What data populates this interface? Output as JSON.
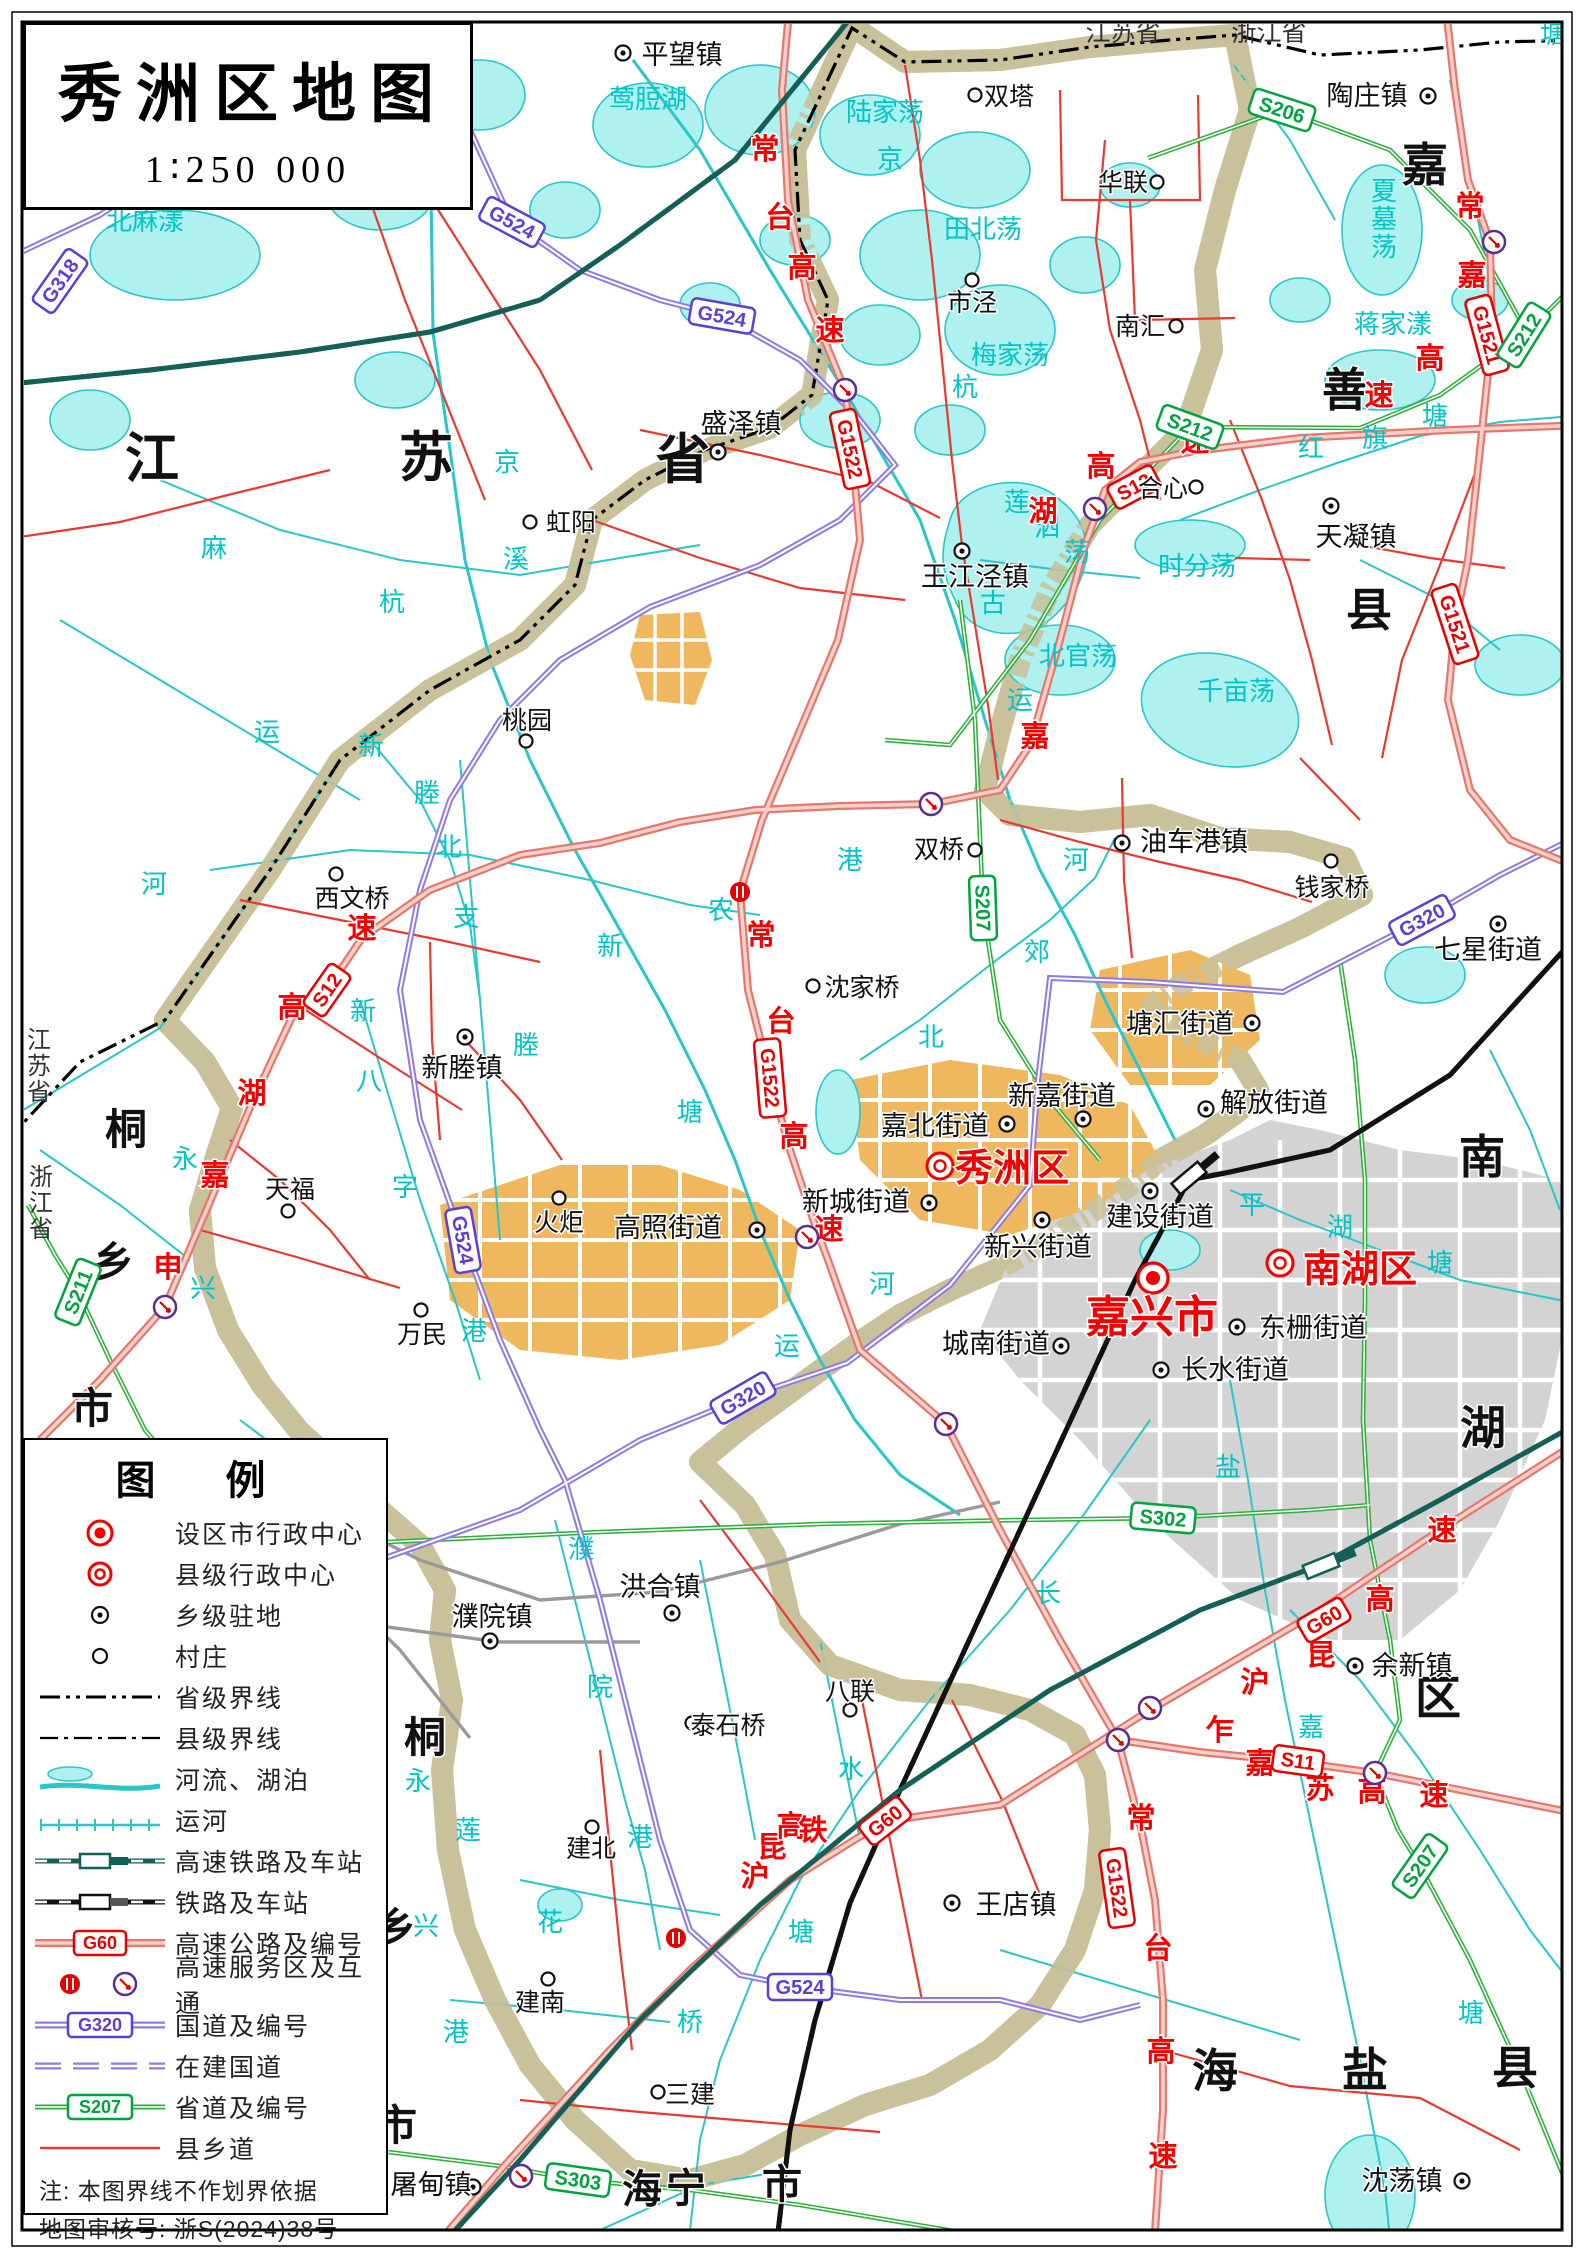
{
  "title": {
    "text": "秀洲区地图",
    "scale": "1∶250 000"
  },
  "legend": {
    "title": "图  例",
    "rows": [
      {
        "sym": "city",
        "label": "设区市行政中心"
      },
      {
        "sym": "county",
        "label": "县级行政中心"
      },
      {
        "sym": "town",
        "label": "乡级驻地"
      },
      {
        "sym": "village",
        "label": "村庄"
      },
      {
        "sym": "provline",
        "label": "省级界线"
      },
      {
        "sym": "countyline",
        "label": "县级界线"
      },
      {
        "sym": "water",
        "label": "河流、湖泊"
      },
      {
        "sym": "canal",
        "label": "运河"
      },
      {
        "sym": "hsr",
        "label": "高速铁路及车站"
      },
      {
        "sym": "rail",
        "label": "铁路及车站"
      },
      {
        "sym": "hwy",
        "label": "高速公路及编号"
      },
      {
        "sym": "service",
        "label": "高速服务区及互通"
      },
      {
        "sym": "nroad",
        "label": "国道及编号"
      },
      {
        "sym": "nbuild",
        "label": "在建国道"
      },
      {
        "sym": "proad",
        "label": "省道及编号"
      },
      {
        "sym": "croad",
        "label": "县乡道"
      }
    ],
    "notes": [
      "注:  本图界线不作划界依据",
      "地图审核号:  浙S(2024)38号"
    ]
  },
  "colors": {
    "district": "#FBF8D0",
    "band": "#C8C19A",
    "water_fill": "#AEF1EF",
    "water_line": "#2AC6C8",
    "urban_grey": "#D3D3D3",
    "urban_orange": "#EFB85F",
    "hwy": "#E4786E",
    "nroad": "#8F7BE8",
    "proad": "#2FAF3C",
    "croad": "#E83A30",
    "hsr": "#145F56",
    "red_text": "#F50000",
    "cyan_text": "#00C4C6"
  },
  "regions": [
    {
      "name": "jiangsu-province-big",
      "fs": 54,
      "chars": [
        {
          "c": "江",
          "x": 152,
          "y": 477
        },
        {
          "c": "苏",
          "x": 426,
          "y": 476
        },
        {
          "c": "省",
          "x": 683,
          "y": 478
        }
      ]
    },
    {
      "name": "jiashan-county",
      "fs": 46,
      "chars": [
        {
          "c": "嘉",
          "x": 1425,
          "y": 181
        },
        {
          "c": "善",
          "x": 1345,
          "y": 406
        },
        {
          "c": "县",
          "x": 1369,
          "y": 626
        }
      ]
    },
    {
      "name": "nanhu-district",
      "fs": 46,
      "chars": [
        {
          "c": "南",
          "x": 1482,
          "y": 1173
        },
        {
          "c": "湖",
          "x": 1483,
          "y": 1444
        },
        {
          "c": "区",
          "x": 1438,
          "y": 1714
        }
      ]
    },
    {
      "name": "tongxiang-city-n",
      "fs": 42,
      "chars": [
        {
          "c": "桐",
          "x": 126,
          "y": 1144
        },
        {
          "c": "乡",
          "x": 113,
          "y": 1277
        },
        {
          "c": "市",
          "x": 92,
          "y": 1423
        }
      ]
    },
    {
      "name": "tongxiang-city-s",
      "fs": 42,
      "chars": [
        {
          "c": "桐",
          "x": 425,
          "y": 1752
        },
        {
          "c": "乡",
          "x": 395,
          "y": 1943
        },
        {
          "c": "市",
          "x": 396,
          "y": 2140
        }
      ]
    },
    {
      "name": "haining-city",
      "fs": 40,
      "chars": [
        {
          "c": "海",
          "x": 642,
          "y": 2203
        },
        {
          "c": "宁",
          "x": 686,
          "y": 2202
        },
        {
          "c": "市",
          "x": 782,
          "y": 2198
        }
      ]
    },
    {
      "name": "haiyan-county",
      "fs": 46,
      "chars": [
        {
          "c": "海",
          "x": 1215,
          "y": 2087
        },
        {
          "c": "盐",
          "x": 1365,
          "y": 2086
        },
        {
          "c": "县",
          "x": 1515,
          "y": 2084
        }
      ]
    }
  ],
  "small_regions": [
    {
      "t": "江苏省",
      "x": 39,
      "y": 1048,
      "vert": true
    },
    {
      "t": "浙江省",
      "x": 41,
      "y": 1185,
      "vert": true
    },
    {
      "t": "江苏省",
      "x": 1123,
      "y": 41,
      "vert": false
    },
    {
      "t": "浙江省",
      "x": 1269,
      "y": 41,
      "vert": false
    }
  ],
  "places": [
    {
      "n": "嘉兴市",
      "t": "city",
      "mx": 1153,
      "my": 1278,
      "lx": 1152,
      "ly": 1318
    },
    {
      "n": "秀洲区",
      "t": "county",
      "mx": 940,
      "my": 1166,
      "lx": 1012,
      "ly": 1167
    },
    {
      "n": "南湖区",
      "t": "county",
      "mx": 1280,
      "my": 1263,
      "lx": 1360,
      "ly": 1268
    },
    {
      "n": "平望镇",
      "t": "town",
      "mx": 623,
      "my": 53,
      "lx": 682,
      "ly": 55
    },
    {
      "n": "陶庄镇",
      "t": "town",
      "mx": 1428,
      "my": 96,
      "lx": 1367,
      "ly": 96
    },
    {
      "n": "盛泽镇",
      "t": "town",
      "mx": 718,
      "my": 452,
      "lx": 741,
      "ly": 424
    },
    {
      "n": "天凝镇",
      "t": "town",
      "mx": 1331,
      "my": 506,
      "lx": 1356,
      "ly": 537
    },
    {
      "n": "王江泾镇",
      "t": "town",
      "mx": 962,
      "my": 551,
      "lx": 975,
      "ly": 577
    },
    {
      "n": "油车港镇",
      "t": "town",
      "mx": 1122,
      "my": 843,
      "lx": 1194,
      "ly": 842
    },
    {
      "n": "七星街道",
      "t": "town",
      "mx": 1498,
      "my": 924,
      "lx": 1488,
      "ly": 950
    },
    {
      "n": "新塍镇",
      "t": "town",
      "mx": 465,
      "my": 1037,
      "lx": 462,
      "ly": 1068
    },
    {
      "n": "塘汇街道",
      "t": "town",
      "mx": 1252,
      "my": 1023,
      "lx": 1180,
      "ly": 1024
    },
    {
      "n": "新嘉街道",
      "t": "town",
      "mx": 1083,
      "my": 1119,
      "lx": 1062,
      "ly": 1096
    },
    {
      "n": "解放街道",
      "t": "town",
      "mx": 1206,
      "my": 1109,
      "lx": 1274,
      "ly": 1103
    },
    {
      "n": "嘉北街道",
      "t": "town",
      "mx": 1007,
      "my": 1124,
      "lx": 935,
      "ly": 1126
    },
    {
      "n": "新城街道",
      "t": "town",
      "mx": 929,
      "my": 1203,
      "lx": 856,
      "ly": 1202
    },
    {
      "n": "建设街道",
      "t": "town",
      "mx": 1150,
      "my": 1191,
      "lx": 1160,
      "ly": 1217
    },
    {
      "n": "高照街道",
      "t": "town",
      "mx": 757,
      "my": 1230,
      "lx": 668,
      "ly": 1228
    },
    {
      "n": "新兴街道",
      "t": "town",
      "mx": 1042,
      "my": 1220,
      "lx": 1038,
      "ly": 1247
    },
    {
      "n": "城南街道",
      "t": "town",
      "mx": 1061,
      "my": 1346,
      "lx": 996,
      "ly": 1344
    },
    {
      "n": "东栅街道",
      "t": "town",
      "mx": 1237,
      "my": 1327,
      "lx": 1313,
      "ly": 1328
    },
    {
      "n": "长水街道",
      "t": "town",
      "mx": 1161,
      "my": 1370,
      "lx": 1235,
      "ly": 1370
    },
    {
      "n": "洪合镇",
      "t": "town",
      "mx": 672,
      "my": 1613,
      "lx": 660,
      "ly": 1587
    },
    {
      "n": "濮院镇",
      "t": "town",
      "mx": 490,
      "my": 1641,
      "lx": 492,
      "ly": 1617
    },
    {
      "n": "王店镇",
      "t": "town",
      "mx": 952,
      "my": 1903,
      "lx": 1016,
      "ly": 1905
    },
    {
      "n": "余新镇",
      "t": "town",
      "mx": 1355,
      "my": 1666,
      "lx": 1412,
      "ly": 1666
    },
    {
      "n": "屠甸镇",
      "t": "town",
      "mx": 473,
      "my": 2187,
      "lx": 431,
      "ly": 2185
    },
    {
      "n": "沈荡镇",
      "t": "town",
      "mx": 1462,
      "my": 2181,
      "lx": 1402,
      "ly": 2181
    },
    {
      "n": "双塔",
      "t": "village",
      "mx": 975,
      "my": 95,
      "lx": 1009,
      "ly": 96
    },
    {
      "n": "华联",
      "t": "village",
      "mx": 1157,
      "my": 182,
      "lx": 1123,
      "ly": 182
    },
    {
      "n": "市泾",
      "t": "village",
      "mx": 972,
      "my": 280,
      "lx": 972,
      "ly": 302
    },
    {
      "n": "南汇",
      "t": "village",
      "mx": 1176,
      "my": 326,
      "lx": 1140,
      "ly": 326
    },
    {
      "n": "合心",
      "t": "village",
      "mx": 1196,
      "my": 487,
      "lx": 1163,
      "ly": 488
    },
    {
      "n": "桃园",
      "t": "village",
      "mx": 526,
      "my": 741,
      "lx": 527,
      "ly": 720
    },
    {
      "n": "虹阳",
      "t": "village",
      "mx": 530,
      "my": 522,
      "lx": 571,
      "ly": 522
    },
    {
      "n": "双桥",
      "t": "village",
      "mx": 975,
      "my": 850,
      "lx": 939,
      "ly": 849
    },
    {
      "n": "钱家桥",
      "t": "village",
      "mx": 1331,
      "my": 861,
      "lx": 1332,
      "ly": 887
    },
    {
      "n": "西文桥",
      "t": "village",
      "mx": 336,
      "my": 874,
      "lx": 352,
      "ly": 898
    },
    {
      "n": "沈家桥",
      "t": "village",
      "mx": 813,
      "my": 986,
      "lx": 862,
      "ly": 987
    },
    {
      "n": "天福",
      "t": "village",
      "mx": 288,
      "my": 1211,
      "lx": 290,
      "ly": 1189
    },
    {
      "n": "火炬",
      "t": "village",
      "mx": 559,
      "my": 1198,
      "lx": 559,
      "ly": 1222
    },
    {
      "n": "万民",
      "t": "village",
      "mx": 421,
      "my": 1310,
      "lx": 422,
      "ly": 1334
    },
    {
      "n": "八联",
      "t": "village",
      "mx": 850,
      "my": 1710,
      "lx": 850,
      "ly": 1691
    },
    {
      "n": "泰石桥",
      "t": "village",
      "mx": 692,
      "my": 1723,
      "lx": 728,
      "ly": 1725
    },
    {
      "n": "建北",
      "t": "village",
      "mx": 592,
      "my": 1827,
      "lx": 591,
      "ly": 1848
    },
    {
      "n": "三建",
      "t": "village",
      "mx": 658,
      "my": 2092,
      "lx": 690,
      "ly": 2094
    },
    {
      "n": "建南",
      "t": "village",
      "mx": 548,
      "my": 1979,
      "lx": 540,
      "ly": 2002
    }
  ],
  "badges": [
    {
      "code": "G318",
      "k": "n",
      "x": 60,
      "y": 281,
      "r": -55
    },
    {
      "code": "G524",
      "k": "n",
      "x": 512,
      "y": 222,
      "r": 28
    },
    {
      "code": "G524",
      "k": "n",
      "x": 722,
      "y": 316,
      "r": 10
    },
    {
      "code": "G524",
      "k": "n",
      "x": 463,
      "y": 1240,
      "r": 80
    },
    {
      "code": "G524",
      "k": "n",
      "x": 800,
      "y": 1987,
      "r": 0
    },
    {
      "code": "G320",
      "k": "n",
      "x": 743,
      "y": 1398,
      "r": -30
    },
    {
      "code": "G320",
      "k": "n",
      "x": 1422,
      "y": 920,
      "r": -28
    },
    {
      "code": "G1522",
      "k": "h",
      "x": 850,
      "y": 449,
      "r": 78
    },
    {
      "code": "G1522",
      "k": "h",
      "x": 770,
      "y": 1078,
      "r": 85
    },
    {
      "code": "G1522",
      "k": "h",
      "x": 1117,
      "y": 1888,
      "r": 82
    },
    {
      "code": "G1521",
      "k": "h",
      "x": 1487,
      "y": 335,
      "r": 75
    },
    {
      "code": "G1521",
      "k": "h",
      "x": 1455,
      "y": 624,
      "r": 72
    },
    {
      "code": "G60",
      "k": "h",
      "x": 885,
      "y": 1821,
      "r": -38
    },
    {
      "code": "G60",
      "k": "h",
      "x": 1324,
      "y": 1620,
      "r": -30
    },
    {
      "code": "S12",
      "k": "h",
      "x": 327,
      "y": 990,
      "r": -55
    },
    {
      "code": "S12",
      "k": "h",
      "x": 1134,
      "y": 487,
      "r": -28
    },
    {
      "code": "S11",
      "k": "h",
      "x": 1298,
      "y": 1761,
      "r": 8
    },
    {
      "code": "S206",
      "k": "p",
      "x": 1282,
      "y": 110,
      "r": 18
    },
    {
      "code": "S212",
      "k": "p",
      "x": 1524,
      "y": 335,
      "r": -58
    },
    {
      "code": "S212",
      "k": "p",
      "x": 1190,
      "y": 427,
      "r": 20
    },
    {
      "code": "S207",
      "k": "p",
      "x": 983,
      "y": 908,
      "r": 88
    },
    {
      "code": "S207",
      "k": "p",
      "x": 1420,
      "y": 1866,
      "r": -55
    },
    {
      "code": "S211",
      "k": "p",
      "x": 78,
      "y": 1292,
      "r": -68
    },
    {
      "code": "S302",
      "k": "p",
      "x": 1163,
      "y": 1518,
      "r": 5
    },
    {
      "code": "S303",
      "k": "p",
      "x": 578,
      "y": 2180,
      "r": 8
    }
  ],
  "expressway_names": [
    {
      "c": "常",
      "x": 765,
      "y": 159
    },
    {
      "c": "台",
      "x": 780,
      "y": 227
    },
    {
      "c": "高",
      "x": 802,
      "y": 277
    },
    {
      "c": "速",
      "x": 830,
      "y": 340
    },
    {
      "c": "常",
      "x": 761,
      "y": 945
    },
    {
      "c": "台",
      "x": 781,
      "y": 1031
    },
    {
      "c": "高",
      "x": 794,
      "y": 1146
    },
    {
      "c": "速",
      "x": 829,
      "y": 1239
    },
    {
      "c": "常",
      "x": 1141,
      "y": 1828
    },
    {
      "c": "台",
      "x": 1158,
      "y": 1958
    },
    {
      "c": "高",
      "x": 1161,
      "y": 2061
    },
    {
      "c": "速",
      "x": 1163,
      "y": 2166
    },
    {
      "c": "申",
      "x": 168,
      "y": 1277
    },
    {
      "c": "嘉",
      "x": 215,
      "y": 1185
    },
    {
      "c": "湖",
      "x": 252,
      "y": 1103
    },
    {
      "c": "高",
      "x": 292,
      "y": 1017
    },
    {
      "c": "速",
      "x": 362,
      "y": 938
    },
    {
      "c": "嘉",
      "x": 1035,
      "y": 746
    },
    {
      "c": "湖",
      "x": 1043,
      "y": 521
    },
    {
      "c": "高",
      "x": 1101,
      "y": 476
    },
    {
      "c": "速",
      "x": 1195,
      "y": 451
    },
    {
      "c": "常",
      "x": 1470,
      "y": 216
    },
    {
      "c": "嘉",
      "x": 1472,
      "y": 285
    },
    {
      "c": "高",
      "x": 1430,
      "y": 368
    },
    {
      "c": "速",
      "x": 1379,
      "y": 405
    },
    {
      "c": "沪",
      "x": 1255,
      "y": 1692
    },
    {
      "c": "昆",
      "x": 1321,
      "y": 1665
    },
    {
      "c": "高",
      "x": 1380,
      "y": 1609
    },
    {
      "c": "速",
      "x": 1442,
      "y": 1540
    },
    {
      "c": "乍",
      "x": 1220,
      "y": 1740
    },
    {
      "c": "嘉",
      "x": 1260,
      "y": 1773
    },
    {
      "c": "苏",
      "x": 1320,
      "y": 1798
    },
    {
      "c": "高",
      "x": 1372,
      "y": 1801
    },
    {
      "c": "速",
      "x": 1434,
      "y": 1805
    },
    {
      "c": "沪",
      "x": 755,
      "y": 1886
    },
    {
      "c": "昆",
      "x": 772,
      "y": 1857
    },
    {
      "c": "高",
      "x": 791,
      "y": 1836
    },
    {
      "c": "铁",
      "x": 813,
      "y": 1840
    }
  ],
  "water_names": [
    {
      "t": "北麻漾",
      "x": 145,
      "y": 230
    },
    {
      "t": "莺脰湖",
      "x": 648,
      "y": 108
    },
    {
      "t": "陆家荡",
      "x": 885,
      "y": 121
    },
    {
      "t": "田北荡",
      "x": 983,
      "y": 238
    },
    {
      "t": "梅家荡",
      "x": 1010,
      "y": 364
    },
    {
      "t": "夏墓荡",
      "x": 1384,
      "y": 200,
      "v": true
    },
    {
      "t": "蒋家漾",
      "x": 1393,
      "y": 333
    },
    {
      "t": "时分荡",
      "x": 1197,
      "y": 575
    },
    {
      "t": "千亩荡",
      "x": 1236,
      "y": 700
    },
    {
      "t": "北官荡",
      "x": 1078,
      "y": 665
    },
    {
      "t": "莲",
      "x": 1017,
      "y": 511
    },
    {
      "t": "泗",
      "x": 1047,
      "y": 536
    },
    {
      "t": "荡",
      "x": 1077,
      "y": 561
    },
    {
      "t": "红",
      "x": 1311,
      "y": 457
    },
    {
      "t": "旗",
      "x": 1375,
      "y": 447
    },
    {
      "t": "塘",
      "x": 1435,
      "y": 425
    },
    {
      "t": "京",
      "x": 890,
      "y": 168
    },
    {
      "t": "杭",
      "x": 965,
      "y": 396
    },
    {
      "t": "古",
      "x": 993,
      "y": 612
    },
    {
      "t": "运",
      "x": 1020,
      "y": 709
    },
    {
      "t": "河",
      "x": 1076,
      "y": 869
    },
    {
      "t": "北",
      "x": 931,
      "y": 1046
    },
    {
      "t": "郊",
      "x": 1037,
      "y": 961
    },
    {
      "t": "麻",
      "x": 214,
      "y": 557
    },
    {
      "t": "溪",
      "x": 516,
      "y": 568
    },
    {
      "t": "京",
      "x": 507,
      "y": 471
    },
    {
      "t": "杭",
      "x": 392,
      "y": 611
    },
    {
      "t": "运",
      "x": 267,
      "y": 741
    },
    {
      "t": "河",
      "x": 154,
      "y": 893
    },
    {
      "t": "新",
      "x": 371,
      "y": 755
    },
    {
      "t": "塍",
      "x": 427,
      "y": 802
    },
    {
      "t": "北",
      "x": 449,
      "y": 856
    },
    {
      "t": "支",
      "x": 466,
      "y": 926
    },
    {
      "t": "新",
      "x": 610,
      "y": 955
    },
    {
      "t": "农",
      "x": 721,
      "y": 919
    },
    {
      "t": "港",
      "x": 850,
      "y": 869
    },
    {
      "t": "塘",
      "x": 690,
      "y": 1121
    },
    {
      "t": "新",
      "x": 363,
      "y": 1020
    },
    {
      "t": "八",
      "x": 369,
      "y": 1090
    },
    {
      "t": "字",
      "x": 405,
      "y": 1196
    },
    {
      "t": "港",
      "x": 474,
      "y": 1340
    },
    {
      "t": "塍",
      "x": 526,
      "y": 1054
    },
    {
      "t": "永",
      "x": 185,
      "y": 1168
    },
    {
      "t": "兴",
      "x": 203,
      "y": 1297
    },
    {
      "t": "运",
      "x": 787,
      "y": 1355
    },
    {
      "t": "河",
      "x": 882,
      "y": 1293
    },
    {
      "t": "平",
      "x": 1252,
      "y": 1214
    },
    {
      "t": "湖",
      "x": 1340,
      "y": 1236
    },
    {
      "t": "塘",
      "x": 1440,
      "y": 1272
    },
    {
      "t": "盐",
      "x": 1228,
      "y": 1476
    },
    {
      "t": "濮",
      "x": 581,
      "y": 1558
    },
    {
      "t": "院",
      "x": 600,
      "y": 1696
    },
    {
      "t": "港",
      "x": 640,
      "y": 1846
    },
    {
      "t": "永",
      "x": 418,
      "y": 1790
    },
    {
      "t": "莲",
      "x": 468,
      "y": 1839
    },
    {
      "t": "兴",
      "x": 426,
      "y": 1935
    },
    {
      "t": "花",
      "x": 550,
      "y": 1931
    },
    {
      "t": "港",
      "x": 456,
      "y": 2041
    },
    {
      "t": "长",
      "x": 1048,
      "y": 1602
    },
    {
      "t": "水",
      "x": 851,
      "y": 1778
    },
    {
      "t": "塘",
      "x": 801,
      "y": 1941
    },
    {
      "t": "桥",
      "x": 690,
      "y": 2031
    },
    {
      "t": "嘉",
      "x": 1311,
      "y": 1736
    },
    {
      "t": "塘",
      "x": 1471,
      "y": 2022
    },
    {
      "t": "塘",
      "x": 1553,
      "y": 43
    }
  ],
  "interchanges": [
    {
      "x": 845,
      "y": 390
    },
    {
      "x": 1494,
      "y": 242
    },
    {
      "x": 1095,
      "y": 509
    },
    {
      "x": 931,
      "y": 804
    },
    {
      "x": 165,
      "y": 1307
    },
    {
      "x": 807,
      "y": 1237
    },
    {
      "x": 946,
      "y": 1424
    },
    {
      "x": 1150,
      "y": 1708
    },
    {
      "x": 1118,
      "y": 1740
    },
    {
      "x": 1375,
      "y": 1773
    },
    {
      "x": 521,
      "y": 2176
    }
  ],
  "service_areas": [
    {
      "x": 740,
      "y": 892
    },
    {
      "x": 676,
      "y": 1938
    }
  ],
  "stations": [
    {
      "x": 1189,
      "y": 1178,
      "rot": -40,
      "k": "rail"
    },
    {
      "x": 1321,
      "y": 1566,
      "rot": -22,
      "k": "hsr"
    }
  ]
}
